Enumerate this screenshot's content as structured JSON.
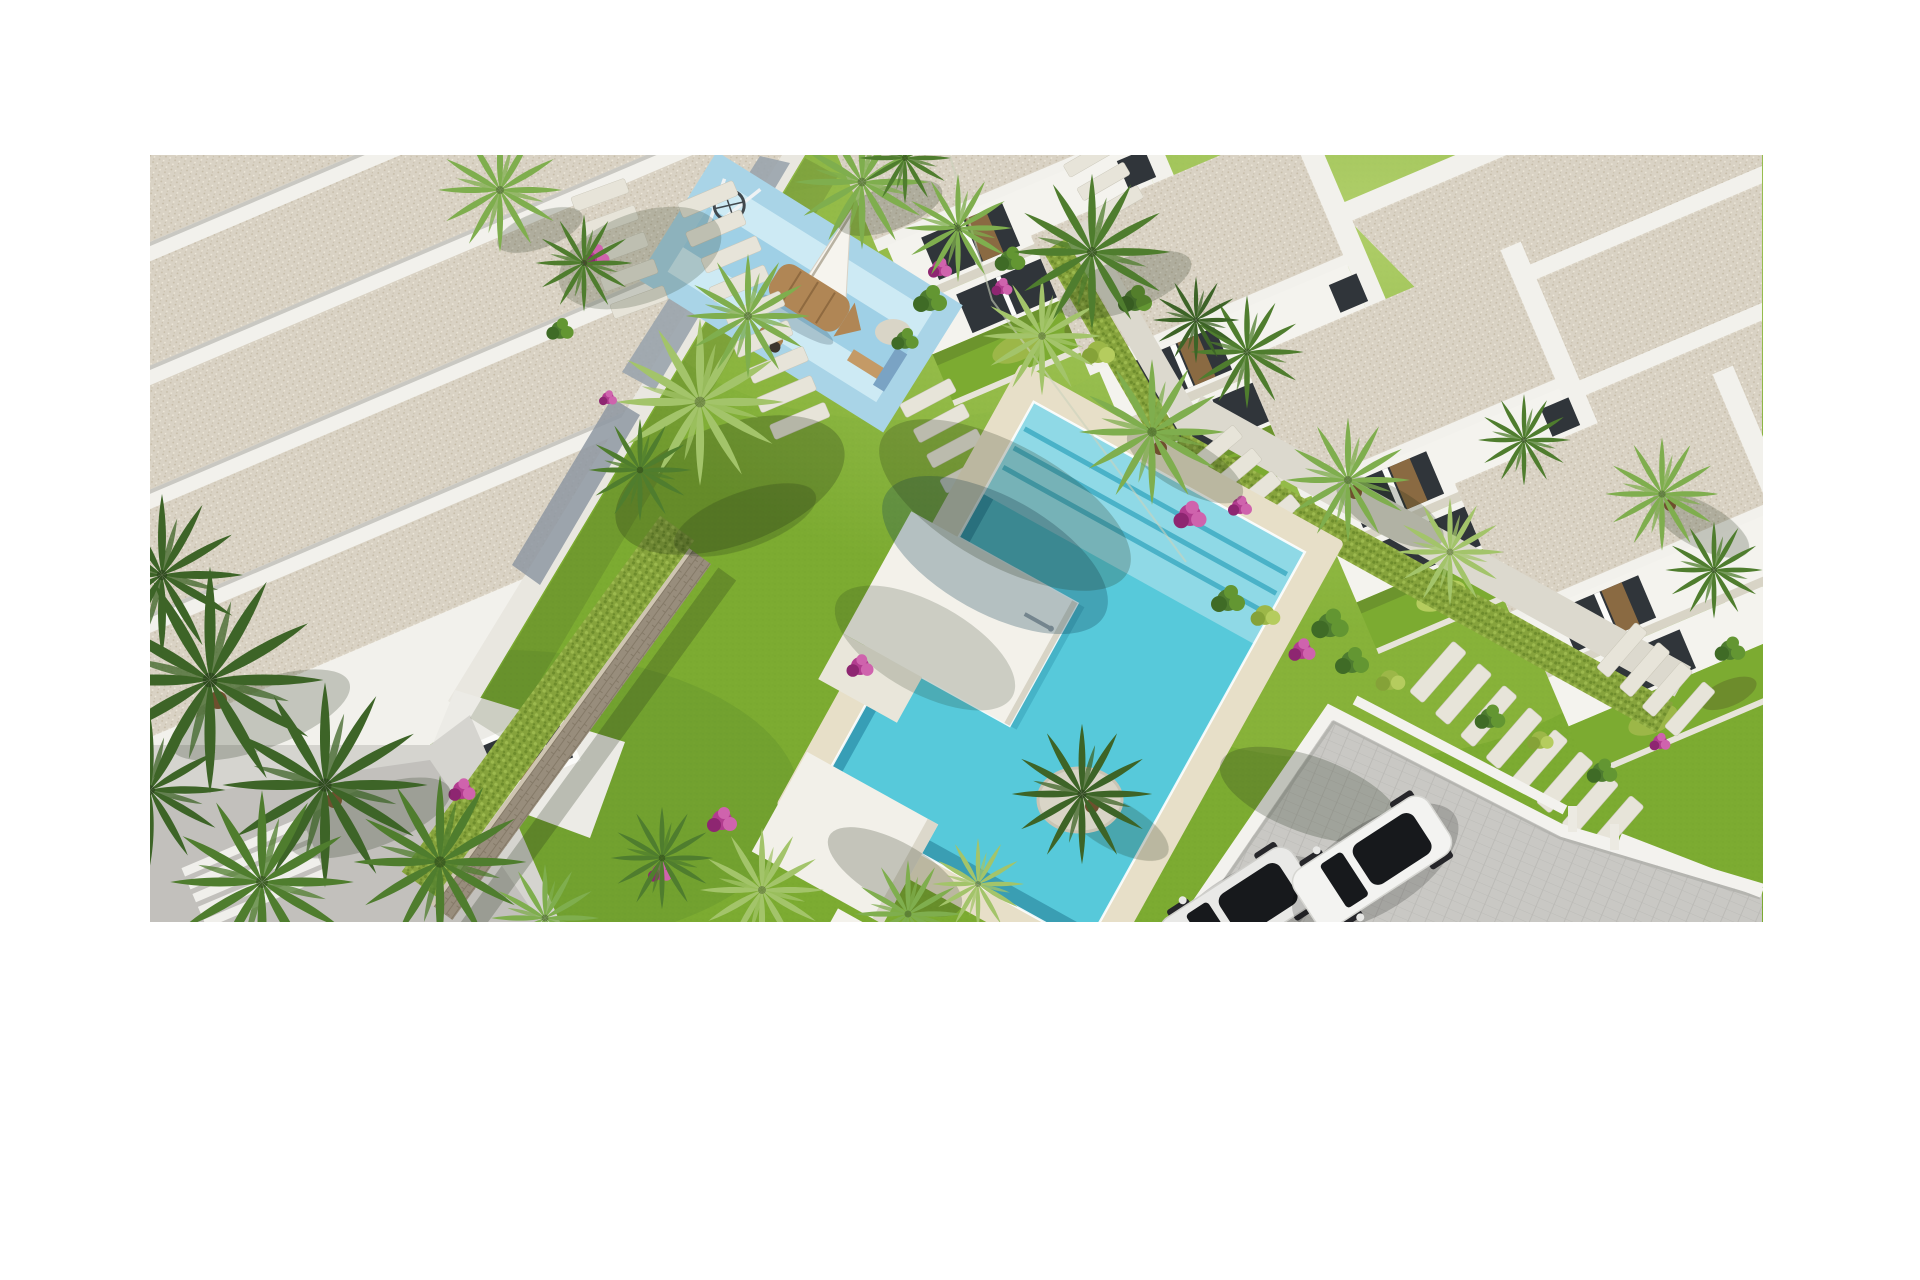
{
  "figure": {
    "alt": "Aerial 3D architectural rendering of a residential complex: white apartment block with gravel flat roofs, children's playground with wooden boat, communal turquoise swimming pool with sun platforms, row of white townhouses, mediterranean gardens with palm trees and a private parking area with two cars"
  },
  "objects": {
    "areas": [
      "apartment-building-northwest",
      "children-playground",
      "communal-swimming-pool",
      "townhouse-row-east",
      "garden-with-palms",
      "private-parking"
    ],
    "vehicles": {
      "count": 2,
      "colors": [
        "white",
        "light-gray"
      ]
    }
  },
  "palette": {
    "page_bg": "#ffffff",
    "grass": "#7cab31",
    "grass_light": "#e4f2a2",
    "roof": "#d9d2c4",
    "roof_dot1": "#c6bca8",
    "roof_dot2": "#efe9db",
    "parapet": "#f2f1ec",
    "wall_lit": "#e9e7e0",
    "wall_shade": "#9aa4ad",
    "wall_shade2": "#8e98a2",
    "facade_white": "#f4f3ee",
    "terrace": "#d5d4cf",
    "terrace_shadow": "#b9b8b3",
    "glass_dark": "#30353a",
    "glass_tan": "#8a6a42",
    "frame": "#fbfbf9",
    "stone": "#988d7c",
    "stone_line": "#857a68",
    "hedge": "#86a33c",
    "hedge_dark": "#6d8c2c",
    "hedge_light": "#9cb94e",
    "pad_outer": "#a9d4e7",
    "pad_inner": "#cdeaf4",
    "pad_band": "#9fd0e6",
    "boat": "#b08655",
    "boat_dark": "#8f6a40",
    "sail": "#f6f4ee",
    "slab": "#e7e4d9",
    "deck": "#e7dfc8",
    "water": "#57c9da",
    "water_shallow": "#8fd9e6",
    "water_step": "#4ab2c8",
    "water_wall": "#2f93ac",
    "platform": "#f3f1ea",
    "platform_shade": "#d8d4c6",
    "canopy": "#f2f0e9",
    "paver": "#c9c8c4",
    "paver_line": "#b9b8b4",
    "curb": "#f3f2ee",
    "car_white": "#f3f3f1",
    "car_gray": "#e9e9e7",
    "glass_black": "#17191c",
    "wheel": "#26262a",
    "palm_dark": "#3d6427",
    "palm_mid": "#4f7d2e",
    "palm_light": "#7fae4e",
    "palm_pale": "#a3c46a",
    "trunk": "#6e4f2e",
    "pink": "#b23c8f",
    "pink_dark": "#8e2671",
    "pink_light": "#cf63ad",
    "bush": "#4e7c30",
    "bush_dark": "#3f6b26",
    "bush_light": "#639632",
    "lime": "#9cb748",
    "lime_light": "#b5cc5e",
    "lime_dark": "#85a238",
    "gravel": "#d9d5c7",
    "gravel_edge": "#c9c4b4",
    "shadow": "#1e2b14",
    "fence": "#ccd2bd",
    "metal": "#9aa0a4"
  }
}
